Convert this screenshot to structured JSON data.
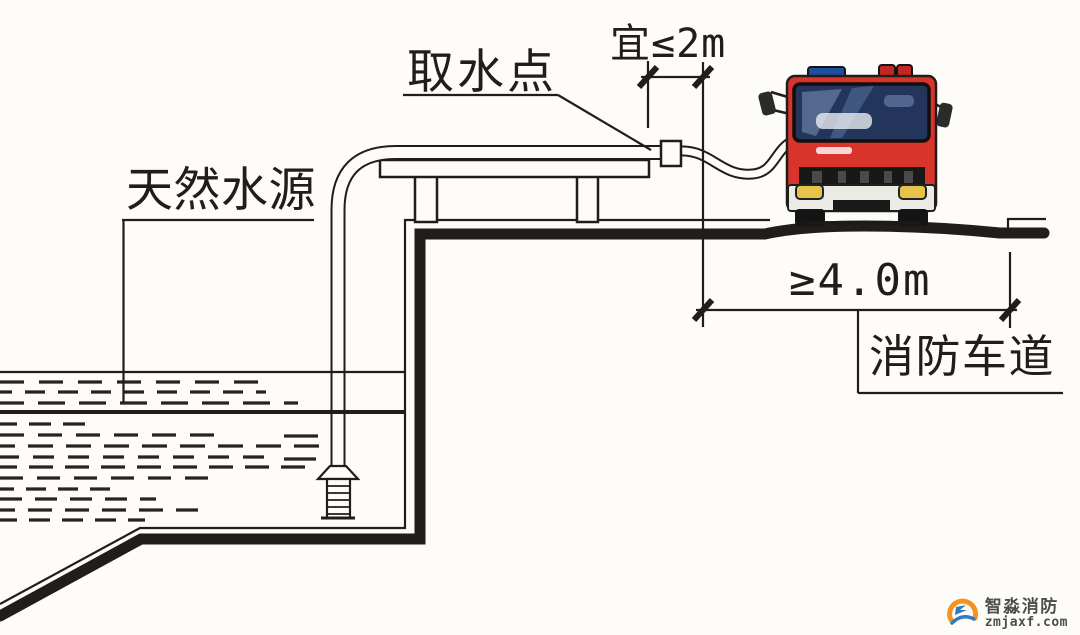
{
  "labels": {
    "natural_water_source": "天然水源",
    "intake_point": "取水点",
    "fire_lane": "消防车道"
  },
  "dimensions": {
    "intake_offset": "宜≤2m",
    "lane_width": "≥4.0m"
  },
  "colors": {
    "ink": "#201d1a",
    "truck_red": "#d8342c",
    "windshield_blue": "#24355c",
    "beacon_blue": "#1d4ea0",
    "beacon_red": "#c52824",
    "headlight_yellow": "#e5c24a",
    "logo_orange": "#f6921e",
    "logo_blue": "#2e7bc0"
  },
  "watermark": {
    "brand": "智淼消防",
    "url": "zmjaxf.com"
  }
}
